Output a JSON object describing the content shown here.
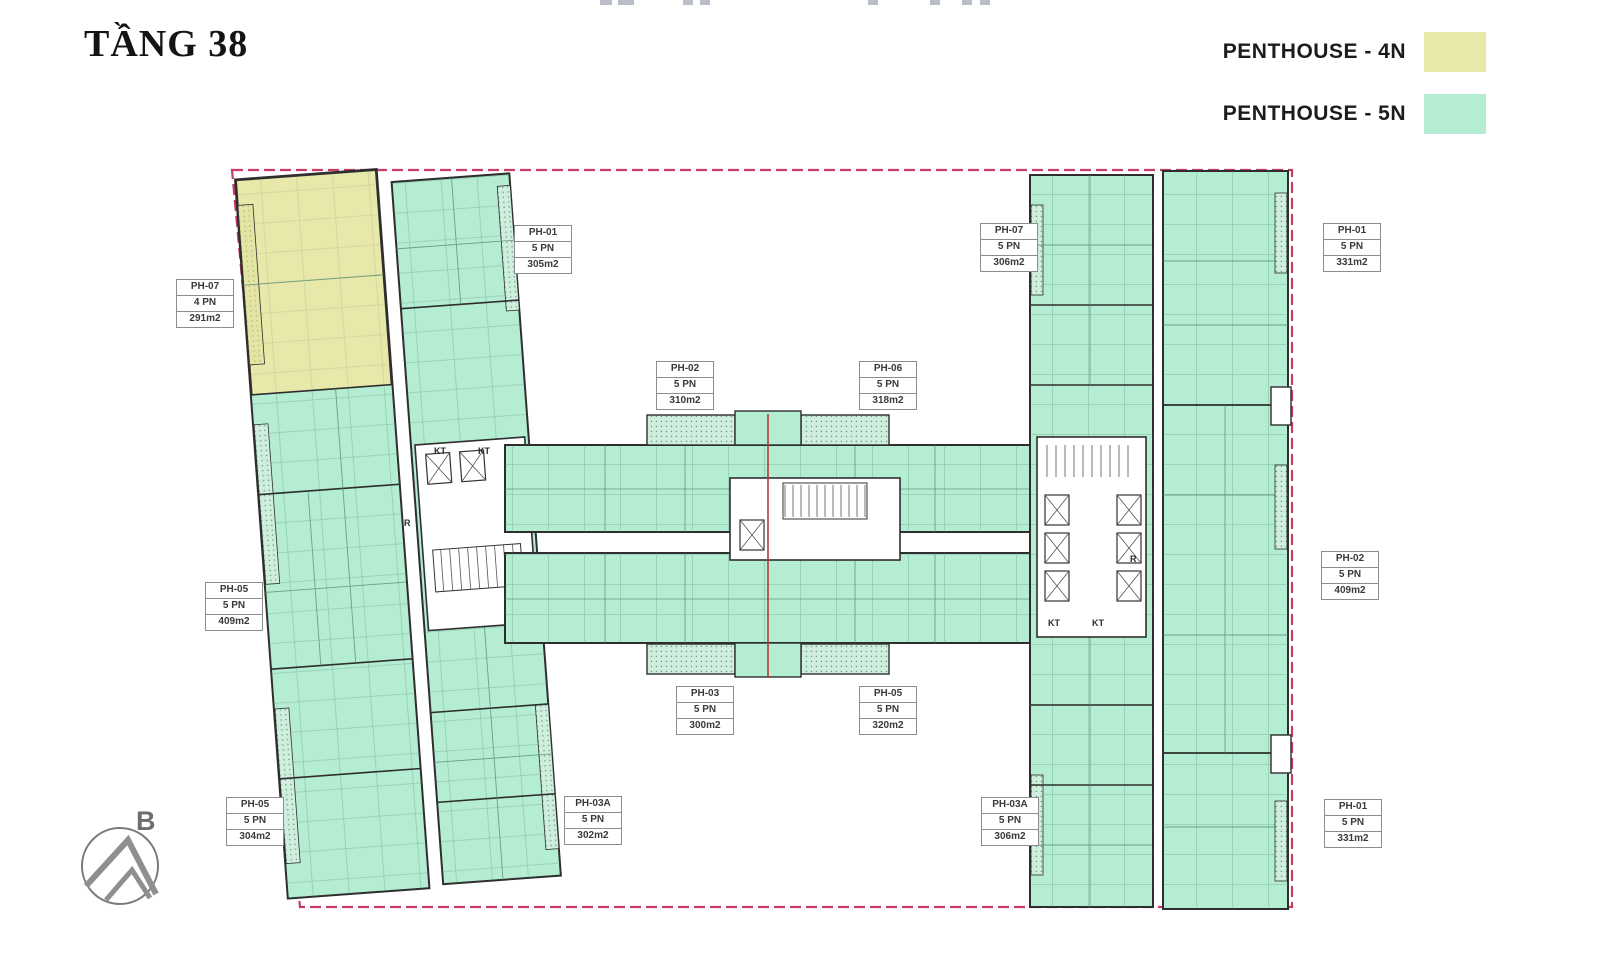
{
  "title": "TẦNG 38",
  "legend": {
    "items": [
      {
        "label": "PENTHOUSE - 4N",
        "color": "#e7e8a9"
      },
      {
        "label": "PENTHOUSE - 5N",
        "color": "#b5edd2"
      }
    ]
  },
  "compass": {
    "label": "B"
  },
  "plan": {
    "boundary_color": "#c73e63",
    "wall_color": "#2e2e2e",
    "unit_fill_5n": "#b5edd2",
    "unit_fill_4n": "#e7e8a9",
    "units": [
      {
        "name": "PH-07",
        "bedrooms": "4 PN",
        "area": "291m2"
      },
      {
        "name": "PH-01",
        "bedrooms": "5 PN",
        "area": "305m2"
      },
      {
        "name": "PH-02",
        "bedrooms": "5 PN",
        "area": "310m2"
      },
      {
        "name": "PH-06",
        "bedrooms": "5 PN",
        "area": "318m2"
      },
      {
        "name": "PH-07",
        "bedrooms": "5 PN",
        "area": "306m2"
      },
      {
        "name": "PH-01",
        "bedrooms": "5 PN",
        "area": "331m2"
      },
      {
        "name": "PH-05",
        "bedrooms": "5 PN",
        "area": "409m2"
      },
      {
        "name": "PH-02",
        "bedrooms": "5 PN",
        "area": "409m2"
      },
      {
        "name": "PH-03",
        "bedrooms": "5 PN",
        "area": "300m2"
      },
      {
        "name": "PH-05",
        "bedrooms": "5 PN",
        "area": "320m2"
      },
      {
        "name": "PH-05",
        "bedrooms": "5 PN",
        "area": "304m2"
      },
      {
        "name": "PH-03A",
        "bedrooms": "5 PN",
        "area": "302m2"
      },
      {
        "name": "PH-03A",
        "bedrooms": "5 PN",
        "area": "306m2"
      },
      {
        "name": "PH-01",
        "bedrooms": "5 PN",
        "area": "331m2"
      }
    ],
    "core_labels": [
      {
        "text": "KT"
      },
      {
        "text": "KT"
      },
      {
        "text": "R"
      },
      {
        "text": "KT"
      },
      {
        "text": "KT"
      },
      {
        "text": "R"
      }
    ]
  }
}
